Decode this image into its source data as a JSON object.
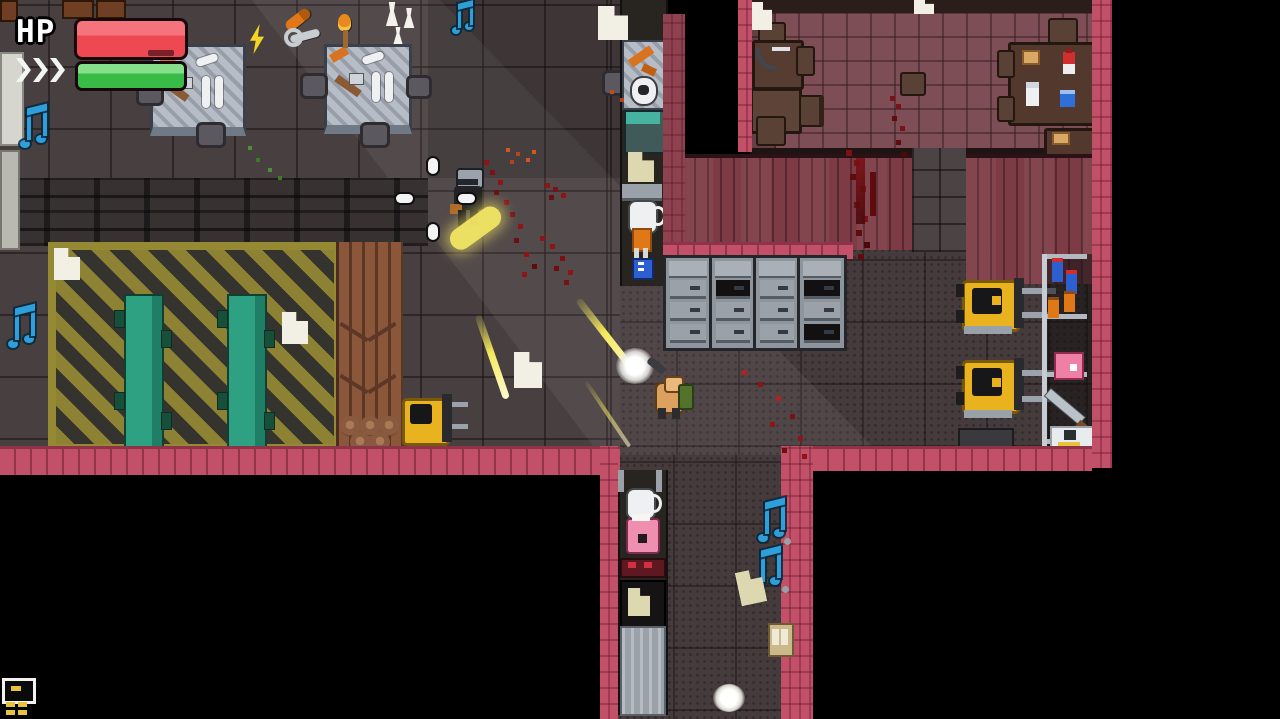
{
  "hud": {
    "hp_label": "HP",
    "hp_percent": 100,
    "hp_bar_color": "#ee4953",
    "boost_percent": 100,
    "boost_bar_color": "#38bb47",
    "boost_chevrons": 3
  },
  "scene": {
    "setting": "top-down pixel-art industrial facility",
    "player": {
      "status": "firing",
      "position": "center corridor"
    },
    "enemy": {
      "status": "firing",
      "position": "upper-left near vents"
    },
    "rooms": [
      "workshop with metal workbenches",
      "hazard-striped conveyor bay",
      "cafeteria with tables and chairs",
      "storage room with forklifts and shelving",
      "supply corridor"
    ],
    "props": [
      "workbench",
      "stool",
      "conveyor belt",
      "wood plank pile",
      "log pile",
      "filing cabinet",
      "forklift",
      "shelving rack",
      "supply shelf",
      "cafeteria table",
      "chair",
      "washing machine",
      "crate"
    ],
    "pickups": [
      "music note",
      "paper note",
      "lightning bolt",
      "club",
      "torch",
      "figurine",
      "wrench",
      "bottle",
      "spray can",
      "pink box",
      "sword",
      "kettle",
      "pink jar",
      "milk bottle",
      "ketchup bottle",
      "bread",
      "blue box"
    ],
    "effects": [
      "muzzle flash",
      "bullet tracer",
      "smoke puff",
      "blood splatter",
      "white orb",
      "bullet projectile"
    ]
  },
  "colors": {
    "background": "#000000",
    "floor": "#483f40",
    "cafeteria_floor": "#7d4e55",
    "pink_wall": "#c25068",
    "maroon_wall": "#7c3b45",
    "hazard_yellow": "#8d8134",
    "conveyor_teal": "#2ea183",
    "forklift_yellow": "#e9b31f",
    "hp_red": "#ee4953",
    "boost_green": "#38bb47",
    "note_blue": "#2f9fdc",
    "blood_red": "#8f1416"
  }
}
